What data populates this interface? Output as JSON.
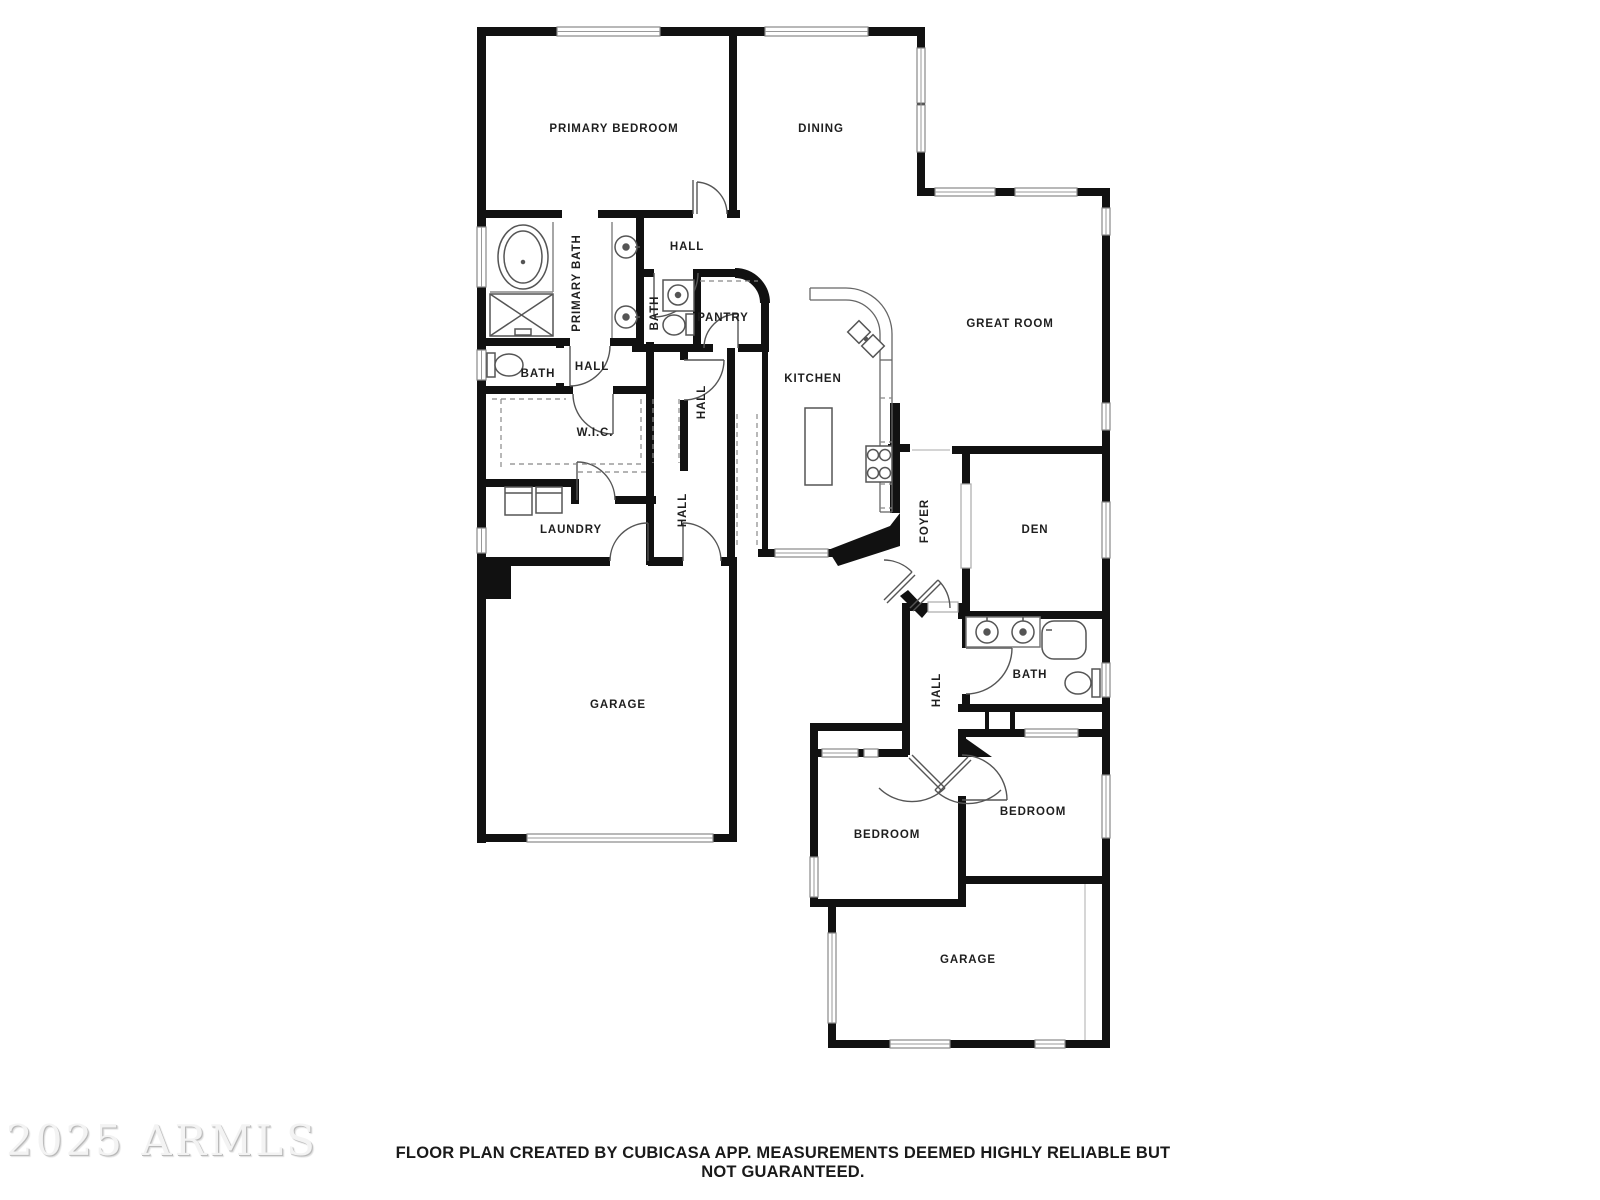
{
  "watermark": "2025 ARMLS",
  "footer": {
    "disclaimer": "FLOOR PLAN CREATED BY CUBICASA APP. MEASUREMENTS DEEMED HIGHLY RELIABLE BUT NOT GUARANTEED."
  },
  "rooms": [
    {
      "label": "PRIMARY BEDROOM"
    },
    {
      "label": "DINING"
    },
    {
      "label": "HALL"
    },
    {
      "label": "PRIMARY BATH"
    },
    {
      "label": "BATH"
    },
    {
      "label": "PANTRY"
    },
    {
      "label": "GREAT ROOM"
    },
    {
      "label": "BATH"
    },
    {
      "label": "HALL"
    },
    {
      "label": "KITCHEN"
    },
    {
      "label": "HALL"
    },
    {
      "label": "W.I.C."
    },
    {
      "label": "LAUNDRY"
    },
    {
      "label": "HALL"
    },
    {
      "label": "FOYER"
    },
    {
      "label": "DEN"
    },
    {
      "label": "BATH"
    },
    {
      "label": "HALL"
    },
    {
      "label": "GARAGE"
    },
    {
      "label": "BEDROOM"
    },
    {
      "label": "BEDROOM"
    },
    {
      "label": "GARAGE"
    }
  ]
}
